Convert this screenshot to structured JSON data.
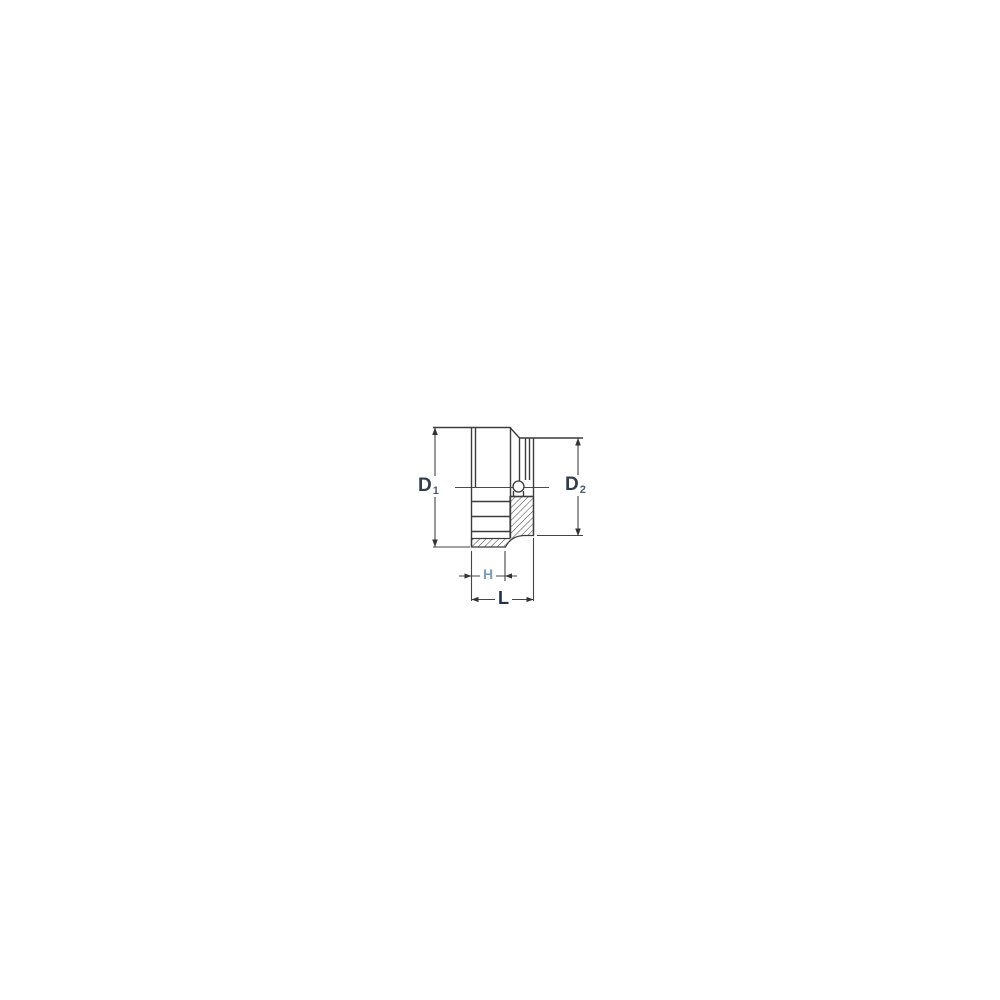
{
  "diagram": {
    "labels": {
      "d1": {
        "main": "D",
        "sub": "1"
      },
      "d2": {
        "main": "D",
        "sub": "2"
      },
      "h": {
        "main": "H",
        "sub": ""
      },
      "l": {
        "main": "L",
        "sub": ""
      }
    },
    "colors": {
      "background": "#ffffff",
      "outline": "#3c3c3c",
      "dimension_line": "#444444",
      "hatch": "#4a4a4a",
      "label_dark": "#333c4a",
      "label_light_blue": "#7d9cba"
    }
  }
}
